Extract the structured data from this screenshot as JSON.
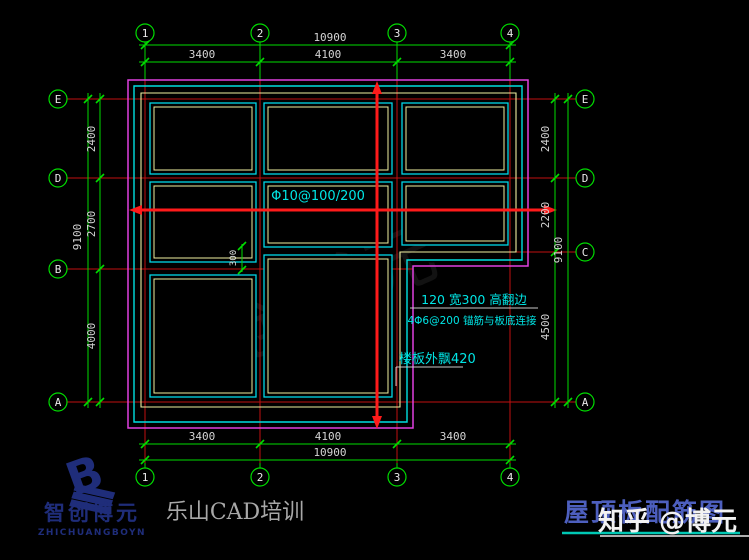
{
  "title_block": {
    "drawing_title": "屋顶板配筋图",
    "watermark": "知乎 @博元",
    "studio": "乐山CAD培训",
    "logo_cn": "智创博元",
    "logo_en": "ZHICHUANGBOYN",
    "logo_letter": "B",
    "faint_watermark": "智创博元"
  },
  "grid_bubbles": {
    "top": [
      "1",
      "2",
      "3",
      "4"
    ],
    "bottom": [
      "1",
      "2",
      "3",
      "4"
    ],
    "left": [
      "E",
      "D",
      "B",
      "A"
    ],
    "right": [
      "E",
      "D",
      "C",
      "A"
    ]
  },
  "dimensions": {
    "top": {
      "overall": "10900",
      "segments": [
        "3400",
        "4100",
        "3400"
      ]
    },
    "bottom": {
      "overall": "10900",
      "segments": [
        "3400",
        "4100",
        "3400"
      ]
    },
    "left": {
      "overall": "9100",
      "segments": [
        "2400",
        "2700",
        "4000"
      ]
    },
    "right": {
      "overall": "9100",
      "segments": [
        "2400",
        "2200",
        "4500"
      ]
    },
    "offset": "300"
  },
  "annotations": {
    "rebar": "Φ10@100/200",
    "upstand": "120 宽300 高翻边",
    "anchor": "4Φ6@200 锚筋与板底连接",
    "overhang": "楼板外飘420"
  },
  "colors": {
    "background": "#000000",
    "dimension_green": "#00dc00",
    "grid_red": "#c01010",
    "rebar_red": "#ff1a1a",
    "outline_magenta": "#e040e0",
    "outline_cyan": "#00e0e0",
    "outline_yellow": "#f0f0a0",
    "annotation_cyan": "#00e5e5",
    "logo_navy": "#1f2d7a",
    "title_blue": "#4d5fbe",
    "underline_teal": "#00c8b4"
  }
}
